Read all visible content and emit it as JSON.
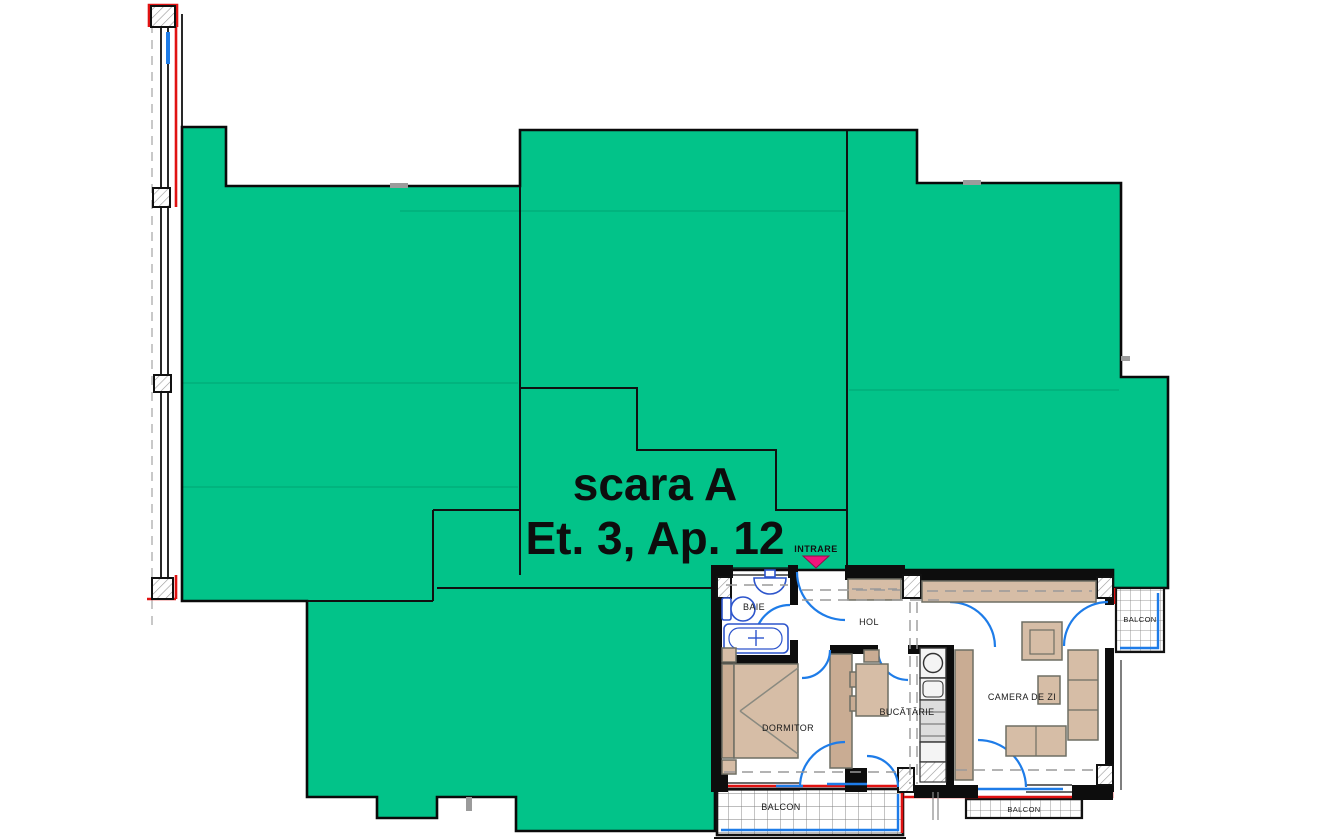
{
  "title": {
    "staircase": "scara A",
    "unit": "Et. 3, Ap. 12"
  },
  "entrance": {
    "label": "INTRARE"
  },
  "rooms": {
    "bathroom": "BAIE",
    "hallway": "HOL",
    "bedroom": "DORMITOR",
    "kitchen": "BUCĂTĂRIE",
    "living_room": "CAMERA DE ZI",
    "balcony_main": "BALCON",
    "balcony_living": "BALCON",
    "balcony_east": "BALCON"
  },
  "colors": {
    "highlight_green": "#02C389",
    "outline_black": "#111111",
    "door_blue": "#1E7CE8",
    "fixture_blue": "#2D55CC",
    "exterior_red": "#E01212",
    "entrance_magenta": "#F0147C",
    "furniture_tan": "#D6BDA6",
    "furniture_tan_dark": "#C9AC93"
  }
}
